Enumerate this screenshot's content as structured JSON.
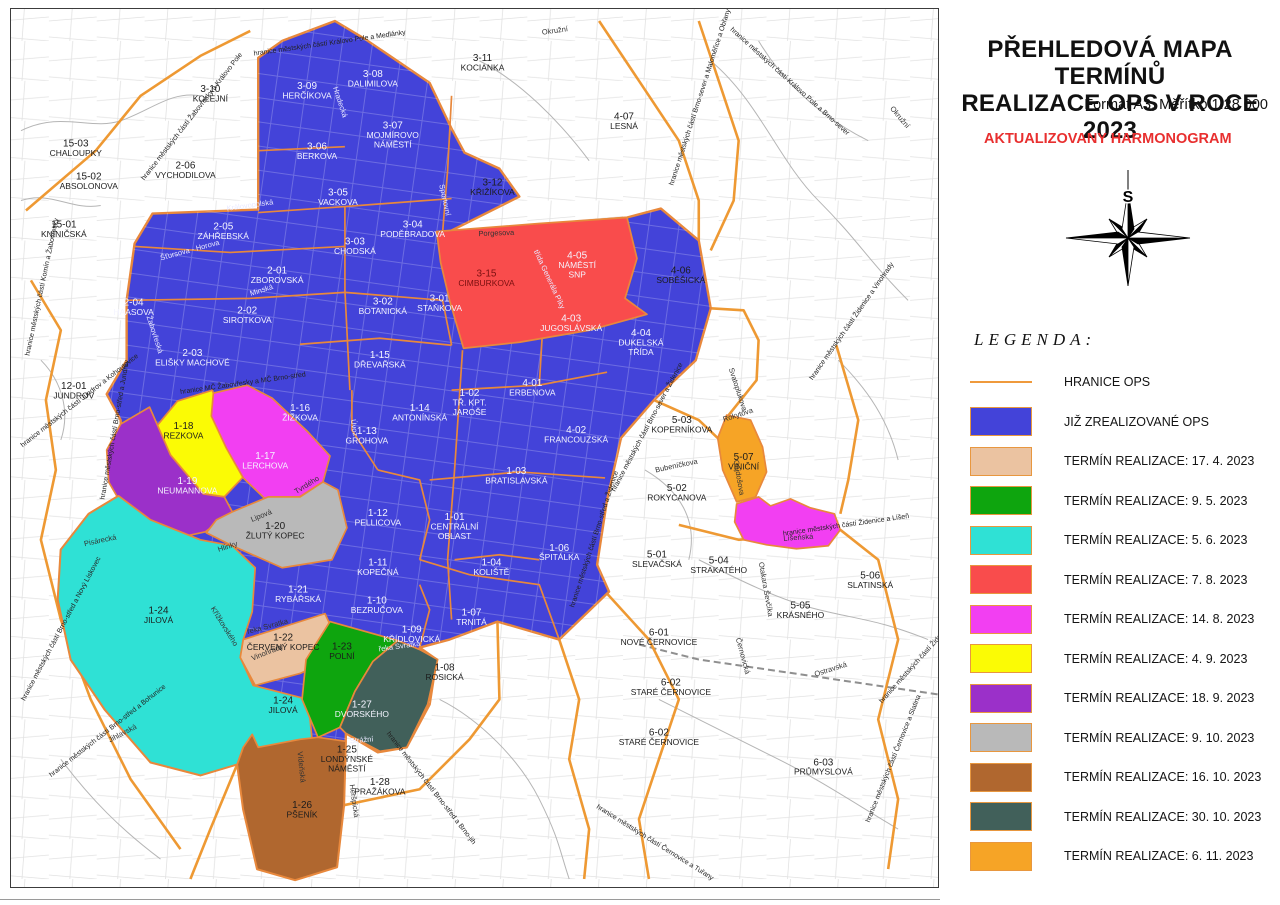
{
  "panel": {
    "title_line1": "PŘEHLEDOVÁ MAPA TERMÍNŮ",
    "title_line2": "REALIZACE OPS V ROCE 2023",
    "subtitle": "Formát A3, Měřítko 1:28 000",
    "note": "AKTUALIZOVANY HARMONOGRAM",
    "legend_title": "LEGENDA:",
    "compass_label": "S",
    "legend": [
      {
        "type": "line",
        "color": "#ef9a3c",
        "label": "HRANICE OPS"
      },
      {
        "type": "swatch",
        "color": "#4343d9",
        "label": "JIŽ ZREALIZOVANÉ OPS"
      },
      {
        "type": "swatch",
        "color": "#ebc3a1",
        "label": "TERMÍN REALIZACE: 17. 4. 2023"
      },
      {
        "type": "swatch",
        "color": "#0ea50e",
        "label": "TERMÍN REALIZACE: 9. 5. 2023"
      },
      {
        "type": "swatch",
        "color": "#2fe1d5",
        "label": "TERMÍN REALIZACE: 5. 6. 2023"
      },
      {
        "type": "swatch",
        "color": "#f94c4c",
        "label": "TERMÍN REALIZACE: 7. 8. 2023"
      },
      {
        "type": "swatch",
        "color": "#f23ff2",
        "label": "TERMÍN REALIZACE: 14. 8. 2023"
      },
      {
        "type": "swatch",
        "color": "#fbfb05",
        "label": "TERMÍN REALIZACE: 4. 9. 2023"
      },
      {
        "type": "swatch",
        "color": "#9b30c9",
        "label": "TERMÍN REALIZACE: 18. 9. 2023"
      },
      {
        "type": "swatch",
        "color": "#b9b9b9",
        "label": "TERMÍN REALIZACE: 9. 10. 2023"
      },
      {
        "type": "swatch",
        "color": "#b0672f",
        "label": "TERMÍN REALIZACE: 16. 10. 2023"
      },
      {
        "type": "swatch",
        "color": "#41605a",
        "label": "TERMÍN REALIZACE: 30. 10. 2023"
      },
      {
        "type": "swatch",
        "color": "#f6a426",
        "label": "TERMÍN REALIZACE: 6. 11. 2023"
      }
    ]
  },
  "map": {
    "districts": [
      {
        "c": "15-03",
        "n": "CHALOUPKY",
        "x": 75,
        "y": 146,
        "t": "b"
      },
      {
        "c": "15-02",
        "n": "ABSOLONOVA",
        "x": 88,
        "y": 179,
        "t": "b"
      },
      {
        "c": "15-01",
        "n": "KNÍNIČSKÁ",
        "x": 63,
        "y": 227,
        "t": "b"
      },
      {
        "c": "3-10",
        "n": "KOLEJNÍ",
        "x": 210,
        "y": 91,
        "t": "b"
      },
      {
        "c": "3-09",
        "n": "HERČÍKOVA",
        "x": 307,
        "y": 88,
        "t": "w"
      },
      {
        "c": "3-08",
        "n": "DALIMILOVA",
        "x": 373,
        "y": 76,
        "t": "w"
      },
      {
        "c": "3-11",
        "n": "KOCIANKA",
        "x": 483,
        "y": 60,
        "t": "b"
      },
      {
        "c": "3-07",
        "n": "MOJMÍROVO\nNÁMĚSTÍ",
        "x": 393,
        "y": 128,
        "t": "w"
      },
      {
        "c": "2-06",
        "n": "VYCHODILOVA",
        "x": 185,
        "y": 168,
        "t": "b"
      },
      {
        "c": "3-06",
        "n": "BERKOVA",
        "x": 317,
        "y": 149,
        "t": "w"
      },
      {
        "c": "3-05",
        "n": "VACKOVA",
        "x": 338,
        "y": 195,
        "t": "w"
      },
      {
        "c": "3-12",
        "n": "KŘIŽÍKOVA",
        "x": 493,
        "y": 185,
        "t": "b"
      },
      {
        "c": "2-05",
        "n": "ZÁHŘEBSKÁ",
        "x": 223,
        "y": 229,
        "t": "w"
      },
      {
        "c": "3-04",
        "n": "PODĚBRADOVA",
        "x": 413,
        "y": 227,
        "t": "w"
      },
      {
        "c": "3-03",
        "n": "CHODSKÁ",
        "x": 355,
        "y": 244,
        "t": "w"
      },
      {
        "c": "2-01",
        "n": "ZBOROVSKÁ",
        "x": 277,
        "y": 273,
        "t": "w"
      },
      {
        "c": "3-15",
        "n": "CIMBURKOVA",
        "x": 487,
        "y": 276,
        "t": "r"
      },
      {
        "c": "4-05",
        "n": "NÁMĚSTÍ\nSNP",
        "x": 578,
        "y": 258,
        "t": "w"
      },
      {
        "c": "2-04",
        "n": "HAASOVA",
        "x": 133,
        "y": 305,
        "t": "w"
      },
      {
        "c": "2-02",
        "n": "SIROTKOVA",
        "x": 247,
        "y": 313,
        "t": "w"
      },
      {
        "c": "3-02",
        "n": "BOTANICKÁ",
        "x": 383,
        "y": 304,
        "t": "w"
      },
      {
        "c": "3-01",
        "n": "STAŇKOVA",
        "x": 440,
        "y": 301,
        "t": "w"
      },
      {
        "c": "4-03",
        "n": "JUGOSLÁVSKÁ",
        "x": 572,
        "y": 321,
        "t": "w"
      },
      {
        "c": "4-04",
        "n": "DUKELSKÁ\nTŘÍDA",
        "x": 642,
        "y": 336,
        "t": "w"
      },
      {
        "c": "4-07",
        "n": "LESNÁ",
        "x": 625,
        "y": 119,
        "t": "b"
      },
      {
        "c": "4-06",
        "n": "SOBĚŠICKÁ",
        "x": 682,
        "y": 273,
        "t": "b"
      },
      {
        "c": "2-03",
        "n": "ELIŠKY MACHOVÉ",
        "x": 192,
        "y": 356,
        "t": "w"
      },
      {
        "c": "1-15",
        "n": "DŘEVAŘSKÁ",
        "x": 380,
        "y": 358,
        "t": "w"
      },
      {
        "c": "12-01",
        "n": "JUNDROV",
        "x": 73,
        "y": 389,
        "t": "b"
      },
      {
        "c": "1-16",
        "n": "ŽIŽKOVA",
        "x": 300,
        "y": 411,
        "t": "w"
      },
      {
        "c": "1-14",
        "n": "ANTONÍNSKÁ",
        "x": 420,
        "y": 411,
        "t": "w"
      },
      {
        "c": "1-02",
        "n": "TŘ. KPT.\nJAROŠE",
        "x": 470,
        "y": 396,
        "t": "w"
      },
      {
        "c": "4-01",
        "n": "ERBENOVA",
        "x": 533,
        "y": 386,
        "t": "w"
      },
      {
        "c": "1-13",
        "n": "GROHOVA",
        "x": 367,
        "y": 434,
        "t": "w"
      },
      {
        "c": "4-02",
        "n": "FRANCOUZSKÁ",
        "x": 577,
        "y": 433,
        "t": "w"
      },
      {
        "c": "1-18",
        "n": "REZKOVA",
        "x": 183,
        "y": 429,
        "t": "b"
      },
      {
        "c": "1-17",
        "n": "LERCHOVA",
        "x": 265,
        "y": 459,
        "t": "w"
      },
      {
        "c": "1-19",
        "n": "NEUMANNOVA",
        "x": 187,
        "y": 484,
        "t": "w"
      },
      {
        "c": "1-03",
        "n": "BRATISLAVSKÁ",
        "x": 517,
        "y": 474,
        "t": "w"
      },
      {
        "c": "1-01",
        "n": "CENTRÁLNÍ\nOBLAST",
        "x": 455,
        "y": 520,
        "t": "w"
      },
      {
        "c": "1-20",
        "n": "ŽLUTÝ KOPEC",
        "x": 275,
        "y": 529,
        "t": "b"
      },
      {
        "c": "1-12",
        "n": "PELLICOVA",
        "x": 378,
        "y": 516,
        "t": "w"
      },
      {
        "c": "5-03",
        "n": "KOPERNÍKOVA",
        "x": 683,
        "y": 423,
        "t": "b"
      },
      {
        "c": "5-07",
        "n": "VINIČNÍ",
        "x": 745,
        "y": 460,
        "t": "b"
      },
      {
        "c": "1-06",
        "n": "ŠPITÁLKA",
        "x": 560,
        "y": 551,
        "t": "w"
      },
      {
        "c": "1-04",
        "n": "KOLIŠTĚ",
        "x": 492,
        "y": 566,
        "t": "w"
      },
      {
        "c": "1-11",
        "n": "KOPEČNÁ",
        "x": 378,
        "y": 566,
        "t": "w"
      },
      {
        "c": "5-02",
        "n": "ROKYCANOVA",
        "x": 678,
        "y": 491,
        "t": "b"
      },
      {
        "c": "1-21",
        "n": "RYBÁŘSKÁ",
        "x": 298,
        "y": 593,
        "t": "w"
      },
      {
        "c": "1-10",
        "n": "BEZRUČOVA",
        "x": 377,
        "y": 604,
        "t": "w"
      },
      {
        "c": "1-07",
        "n": "TRNITÁ",
        "x": 472,
        "y": 616,
        "t": "w"
      },
      {
        "c": "1-09",
        "n": "KŘÍDLOVICKÁ",
        "x": 412,
        "y": 633,
        "t": "w"
      },
      {
        "c": "5-01",
        "n": "SLEVAČSKÁ",
        "x": 658,
        "y": 558,
        "t": "b"
      },
      {
        "c": "5-04",
        "n": "STRAKATÉHO",
        "x": 720,
        "y": 564,
        "t": "b"
      },
      {
        "c": "5-06",
        "n": "SLATINSKÁ",
        "x": 872,
        "y": 579,
        "t": "b"
      },
      {
        "c": "5-05",
        "n": "KRÁSNÉHO",
        "x": 802,
        "y": 609,
        "t": "b"
      },
      {
        "c": "1-22",
        "n": "ČERVENÝ KOPEC",
        "x": 283,
        "y": 641,
        "t": "b"
      },
      {
        "c": "1-23",
        "n": "POLNÍ",
        "x": 342,
        "y": 650,
        "t": "b"
      },
      {
        "c": "1-08",
        "n": "ROSICKÁ",
        "x": 445,
        "y": 671,
        "t": "b"
      },
      {
        "c": "1-24",
        "n": "JILOVÁ",
        "x": 158,
        "y": 614,
        "t": "b"
      },
      {
        "c": "1-24",
        "n": "JILOVÁ",
        "x": 283,
        "y": 704,
        "t": "b"
      },
      {
        "c": "1-27",
        "n": "DVORSKÉHO",
        "x": 362,
        "y": 708,
        "t": "w"
      },
      {
        "c": "6-01",
        "n": "NOVÉ ČERNOVICE",
        "x": 660,
        "y": 636,
        "t": "b"
      },
      {
        "c": "1-25",
        "n": "LONDÝNSKÉ\nNÁMĚSTÍ",
        "x": 347,
        "y": 753,
        "t": "b"
      },
      {
        "c": "1-28",
        "n": "PRAŽÁKOVA",
        "x": 380,
        "y": 786,
        "t": "b"
      },
      {
        "c": "6-02",
        "n": "STARÉ ČERNOVICE",
        "x": 672,
        "y": 686,
        "t": "b"
      },
      {
        "c": "6-02",
        "n": "STARÉ ČERNOVICE",
        "x": 660,
        "y": 736,
        "t": "b"
      },
      {
        "c": "1-26",
        "n": "PŠENÍK",
        "x": 302,
        "y": 809,
        "t": "b"
      },
      {
        "c": "6-03",
        "n": "PRŮMYSLOVÁ",
        "x": 825,
        "y": 766,
        "t": "b"
      }
    ],
    "streets": [
      {
        "n": "Porgesova",
        "x": 497,
        "y": 235,
        "r": -2,
        "t": "b"
      },
      {
        "n": "Sportovní",
        "x": 443,
        "y": 200,
        "r": 78,
        "t": "w"
      },
      {
        "n": "Hradecká",
        "x": 338,
        "y": 102,
        "r": 72,
        "t": "w"
      },
      {
        "n": "Okružní",
        "x": 556,
        "y": 32,
        "r": -8,
        "t": "b"
      },
      {
        "n": "Okružní",
        "x": 900,
        "y": 118,
        "r": 50,
        "t": "b"
      },
      {
        "n": "Královopolská",
        "x": 250,
        "y": 207,
        "r": -8,
        "t": "w"
      },
      {
        "n": "Minská",
        "x": 262,
        "y": 292,
        "r": -18,
        "t": "w"
      },
      {
        "n": "Šťursova - Horova",
        "x": 190,
        "y": 252,
        "r": -15,
        "t": "w"
      },
      {
        "n": "Žabovřeská",
        "x": 152,
        "y": 335,
        "r": 72,
        "t": "w"
      },
      {
        "n": "Úvoz",
        "x": 352,
        "y": 428,
        "r": 82,
        "t": "w"
      },
      {
        "n": "Lipová",
        "x": 262,
        "y": 518,
        "r": -22,
        "t": "b"
      },
      {
        "n": "Hlinky",
        "x": 228,
        "y": 549,
        "r": -18,
        "t": "b"
      },
      {
        "n": "Tvrdého",
        "x": 308,
        "y": 487,
        "r": -32,
        "t": "b"
      },
      {
        "n": "Vinohrady",
        "x": 268,
        "y": 655,
        "r": -22,
        "t": "b"
      },
      {
        "n": "Pisárecká",
        "x": 100,
        "y": 543,
        "r": -12,
        "t": "b"
      },
      {
        "n": "Jihlavská",
        "x": 123,
        "y": 736,
        "r": -28,
        "t": "b"
      },
      {
        "n": "Křížkovského",
        "x": 222,
        "y": 628,
        "r": 58,
        "t": "b"
      },
      {
        "n": "řeka Svratka",
        "x": 268,
        "y": 629,
        "r": -15,
        "t": "b"
      },
      {
        "n": "řeka Svratka",
        "x": 400,
        "y": 649,
        "r": -8,
        "t": "w"
      },
      {
        "n": "Strážní",
        "x": 362,
        "y": 743,
        "r": -5,
        "t": "w"
      },
      {
        "n": "Heršpická",
        "x": 352,
        "y": 802,
        "r": 82,
        "t": "b"
      },
      {
        "n": "Vídeňská",
        "x": 299,
        "y": 768,
        "r": 84,
        "t": "b"
      },
      {
        "n": "Líšeňská",
        "x": 800,
        "y": 540,
        "r": -4,
        "t": "b"
      },
      {
        "n": "Rokytova",
        "x": 740,
        "y": 417,
        "r": -18,
        "t": "b"
      },
      {
        "n": "Svatoplukova",
        "x": 737,
        "y": 390,
        "r": 72,
        "t": "b"
      },
      {
        "n": "Gajdošova",
        "x": 738,
        "y": 478,
        "r": 80,
        "t": "b"
      },
      {
        "n": "Bubeníčkova",
        "x": 678,
        "y": 468,
        "r": -12,
        "t": "b"
      },
      {
        "n": "Ostravská",
        "x": 833,
        "y": 672,
        "r": -18,
        "t": "b"
      },
      {
        "n": "Černovická",
        "x": 742,
        "y": 657,
        "r": 75,
        "t": "b"
      },
      {
        "n": "Otakara Ševčíka",
        "x": 765,
        "y": 590,
        "r": 80,
        "t": "b"
      },
      {
        "n": "třída Generála Píky",
        "x": 548,
        "y": 280,
        "r": 65,
        "t": "w"
      }
    ],
    "boundaries": [
      {
        "n": "hranice městských částí Královo Pole a Medlánky",
        "x": 330,
        "y": 44,
        "r": -8
      },
      {
        "n": "hranice městských částí Královo Pole a Brno-sever",
        "x": 790,
        "y": 82,
        "r": 42
      },
      {
        "n": "hranice městských částí Žabovřesky a Královo Pole",
        "x": 193,
        "y": 117,
        "r": -52
      },
      {
        "n": "hranice městských částí Komín a Žabovřesky",
        "x": 43,
        "y": 287,
        "r": -78
      },
      {
        "n": "hranice MČ Žabovřesky a MČ Brno-střed",
        "x": 243,
        "y": 385,
        "r": -8
      },
      {
        "n": "hranice městských částí Jundrov a Kohoutovice",
        "x": 80,
        "y": 402,
        "r": -38
      },
      {
        "n": "hranice městských částí Brno-střed a Jundrov",
        "x": 116,
        "y": 430,
        "r": -80
      },
      {
        "n": "hranice městských částí Brno-sever a Maloměřice a Obřany",
        "x": 703,
        "y": 97,
        "r": -72
      },
      {
        "n": "hranice městských částí Brno-sever a Židenice",
        "x": 650,
        "y": 428,
        "r": -62
      },
      {
        "n": "hranice městských částí Brno-střed a Židenice",
        "x": 597,
        "y": 540,
        "r": -72
      },
      {
        "n": "hranice městských částí Židenice a Vinohrady",
        "x": 855,
        "y": 322,
        "r": -55
      },
      {
        "n": "hranice městských částí Židenice a Líšeň",
        "x": 848,
        "y": 527,
        "r": -8
      },
      {
        "n": "hranice městských částí Brno-střed a Nový Lískovec",
        "x": 62,
        "y": 630,
        "r": -62
      },
      {
        "n": "hranice městských částí Brno-střed a Bohunice",
        "x": 108,
        "y": 733,
        "r": -38
      },
      {
        "n": "hranice městských částí Brno-střed a Brno-jih",
        "x": 430,
        "y": 790,
        "r": 52
      },
      {
        "n": "hranice městských částí Černovice a Tuřany",
        "x": 655,
        "y": 845,
        "r": 32
      },
      {
        "n": "hranice městských částí Černovice a Slatina",
        "x": 897,
        "y": 760,
        "r": -68
      },
      {
        "n": "hranice městských částí Židenice a Slatina",
        "x": 928,
        "y": 655,
        "r": -48
      }
    ],
    "colors": {
      "realized": "#4343d9",
      "ops_border": "#e8883c",
      "municipal_border": "#ee9933",
      "red": "#f94c4c",
      "magenta": "#f23ff2",
      "yellow": "#fbfb05",
      "purple": "#9b30c9",
      "gray": "#b9b9b9",
      "cyan": "#2fe1d5",
      "green": "#0ea50e",
      "tan": "#ebc3a1",
      "brown": "#b0672f",
      "darkteal": "#41605a",
      "orange": "#f6a426"
    }
  }
}
